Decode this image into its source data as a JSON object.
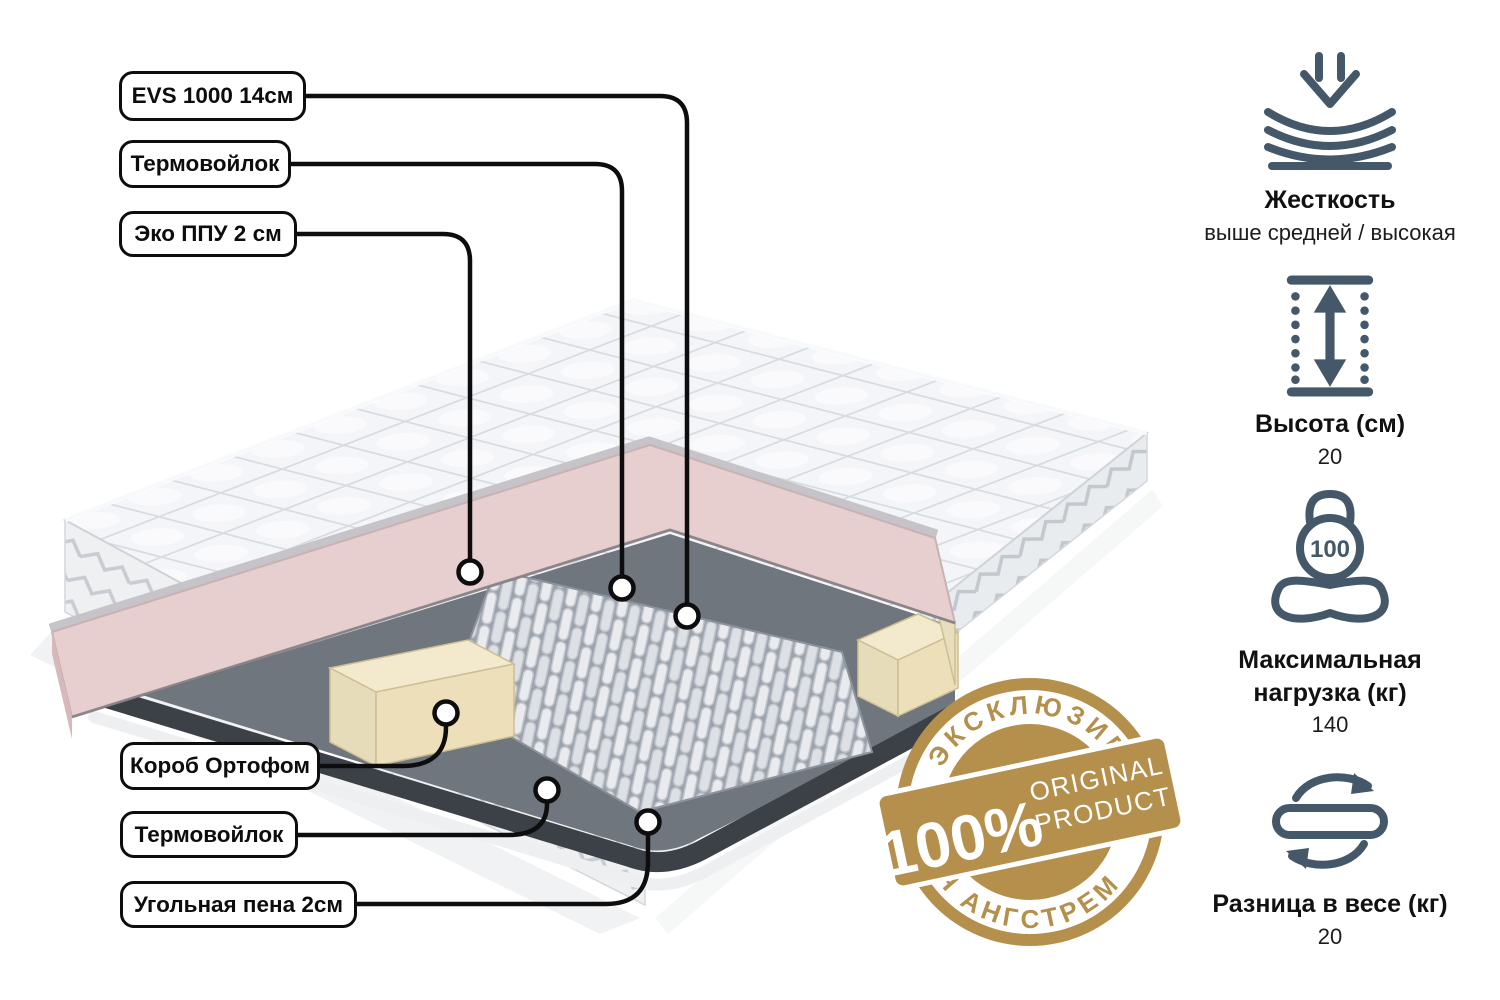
{
  "colors": {
    "accent_slate": "#44586a",
    "badge_gold": "#b5904c",
    "pink_layer": "#e8cfcf",
    "cream_foam": "#efe5c6",
    "felt_gray": "#70767e",
    "charcoal": "#3c4147",
    "line_black": "#0d0d0d"
  },
  "callouts": {
    "top": [
      {
        "label": "EVS 1000 14см"
      },
      {
        "label": "Термовойлок"
      },
      {
        "label": "Эко ППУ 2 см"
      }
    ],
    "bottom": [
      {
        "label": "Короб Ортофом"
      },
      {
        "label": "Термовойлок"
      },
      {
        "label": "Угольная пена 2см"
      }
    ]
  },
  "specs": [
    {
      "icon": "firmness-icon",
      "title": "Жесткость",
      "value": "выше средней / высокая"
    },
    {
      "icon": "height-icon",
      "title": "Высота (см)",
      "value": "20"
    },
    {
      "icon": "max-load-icon",
      "title": "Максимальная нагрузка (кг)",
      "value": "140"
    },
    {
      "icon": "weight-difference-icon",
      "title": "Разница в весе (кг)",
      "value": "20"
    }
  ],
  "badge": {
    "arc_top": "ЭКСКЛЮЗИВНО",
    "percent": "100%",
    "word1": "ORIGINAL",
    "word2": "PRODUCT",
    "arc_bottom": "ДЛЯ АНГСТРЕМ"
  },
  "kettlebell_label": "100"
}
